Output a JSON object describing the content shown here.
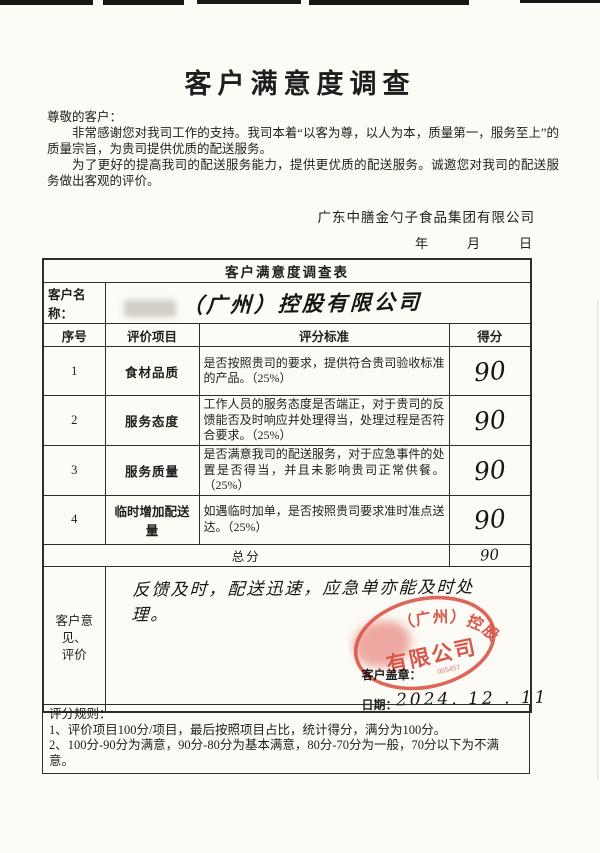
{
  "document": {
    "title": "客户满意度调查",
    "salutation": "尊敬的客户：",
    "para1": "非常感谢您对我司工作的支持。我司本着“以客为尊，以人为本，质量第一，服务至上”的质量宗旨，为贵司提供优质的配送服务。",
    "para2": "为了更好的提高我司的配送服务能力，提供更优质的配送服务。诚邀您对我司的配送服务做出客观的评价。",
    "company_signature": "广东中膳金勺子食品集团有限公司",
    "date_labels": {
      "year": "年",
      "month": "月",
      "day": "日"
    }
  },
  "survey_table": {
    "title": "客户满意度调查表",
    "customer_label": "客户名称：",
    "customer_value": "（广州）控股有限公司",
    "headers": {
      "no": "序号",
      "item": "评价项目",
      "criteria": "评分标准",
      "score": "得分"
    },
    "rows": [
      {
        "no": "1",
        "item": "食材品质",
        "criteria": "是否按照贵司的要求，提供符合贵司验收标准的产品。（25%）",
        "score": "90"
      },
      {
        "no": "2",
        "item": "服务态度",
        "criteria": "工作人员的服务态度是否端正，对于贵司的反馈能否及时响应并处理得当，处理过程是否符合要求。（25%）",
        "score": "90"
      },
      {
        "no": "3",
        "item": "服务质量",
        "criteria": "是否满意我司的配送服务，对于应急事件的处置是否得当，并且未影响贵司正常供餐。（25%）",
        "score": "90"
      },
      {
        "no": "4",
        "item": "临时增加配送量",
        "criteria": "如遇临时加单，是否按照贵司要求准时准点送达。（25%）",
        "score": "90"
      }
    ],
    "total_label": "总分",
    "total_value": "90",
    "opinion_label_line1": "客户意见、",
    "opinion_label_line2": "评价",
    "opinion_text": "反馈及时，配送迅速，应急单亦能及时处理。",
    "stamp_label": "客户盖章：",
    "date_label": "日期：",
    "date_value": "2024. 12 . 11"
  },
  "stamp": {
    "arc_text": "（广州）控股",
    "center_text": "有限公司",
    "serial": "065457"
  },
  "rules": {
    "heading": "评分规则：",
    "rule1": "1、评价项目100分/项目，最后按照项目占比，统计得分，满分为100分。",
    "rule2": "2、100分-90分为满意，90分-80分为基本满意，80分-70分为一般，70分以下为不满意。"
  },
  "colors": {
    "stamp_red": "#d94a3e",
    "border": "#2d2d2d",
    "paper": "#fcfbf6",
    "ink": "#1e1e1e"
  }
}
